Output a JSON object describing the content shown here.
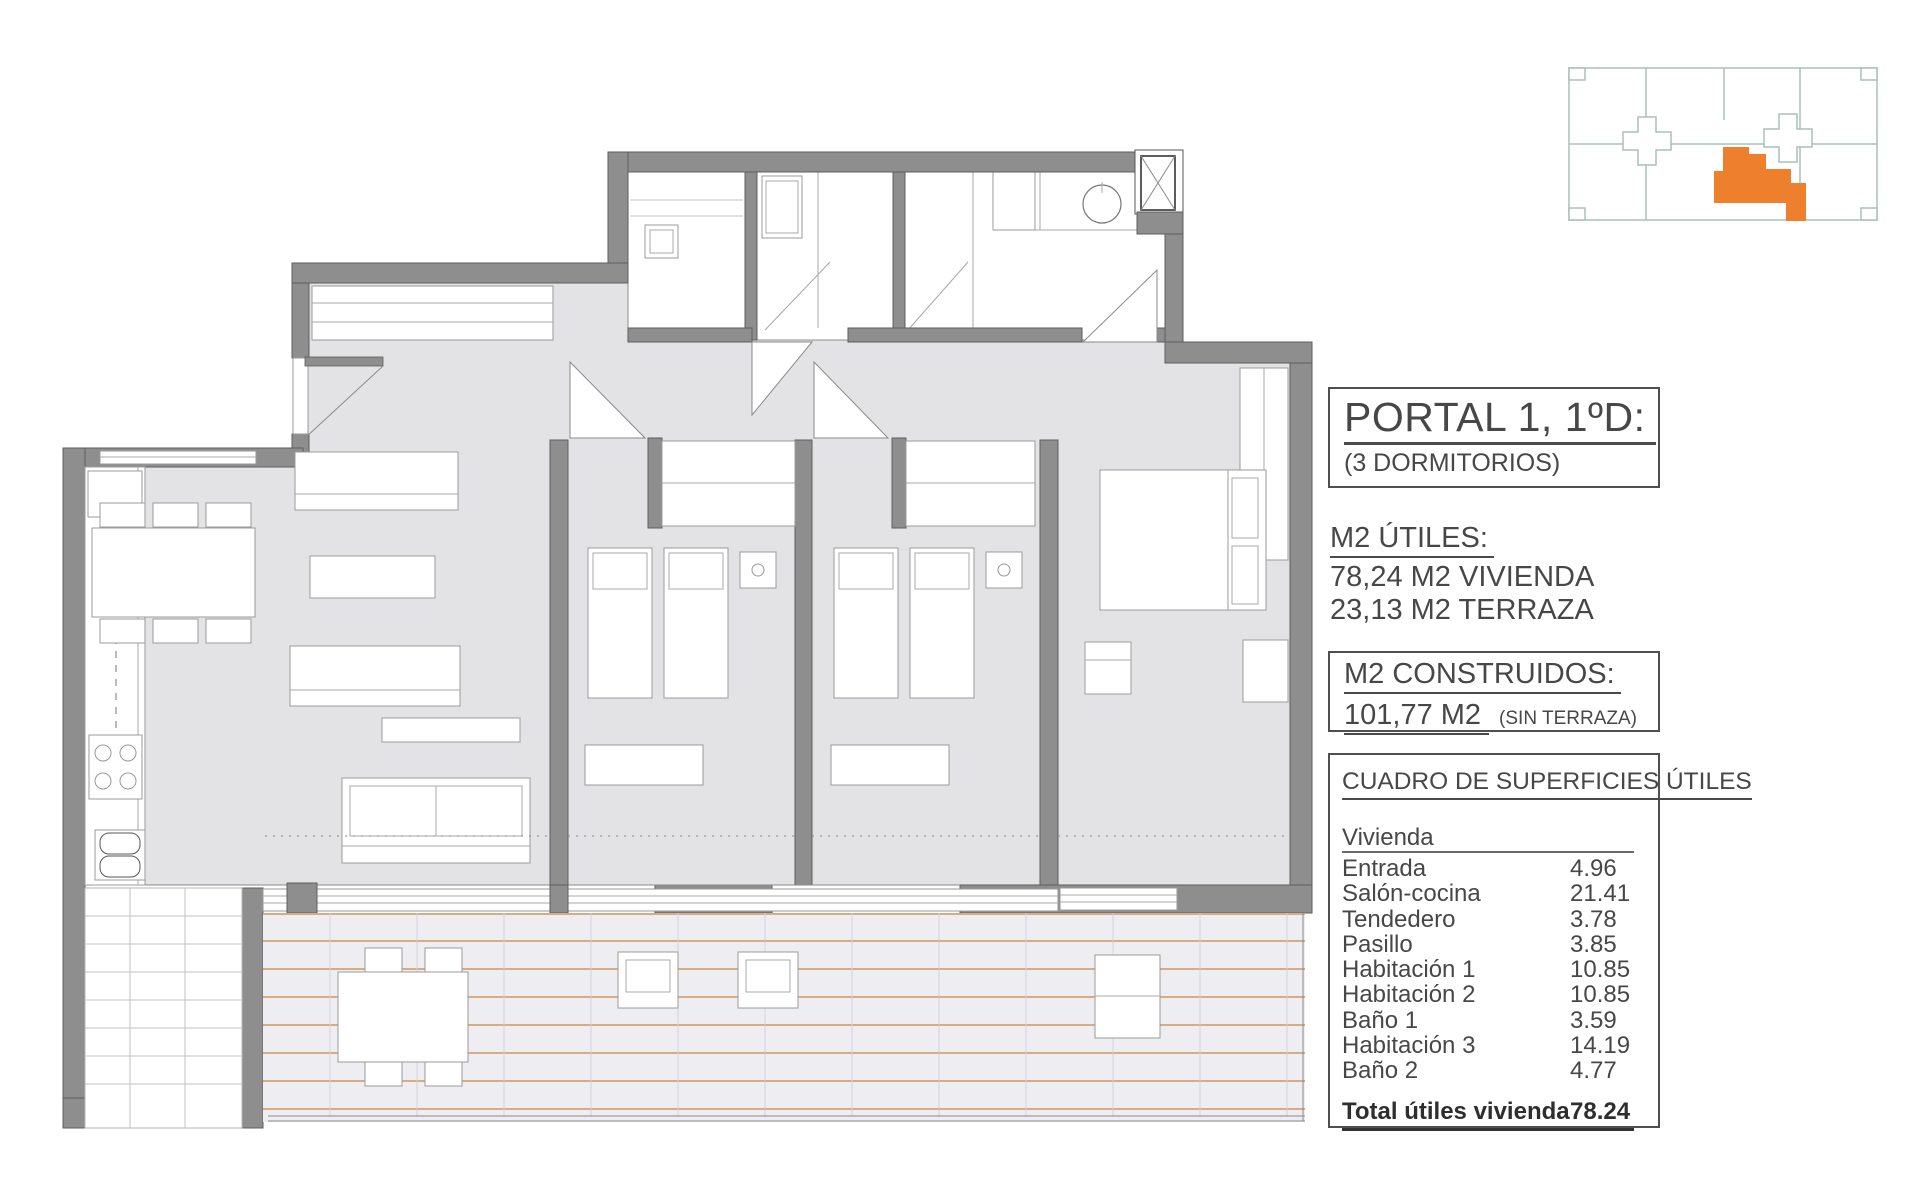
{
  "title_block": {
    "portal": {
      "title": "PORTAL 1, 1ºD:",
      "subtitle": "(3 DORMITORIOS)"
    },
    "utiles": {
      "heading": "M2 ÚTILES:",
      "line1": "78,24 M2 VIVIENDA",
      "line2": "23,13 M2 TERRAZA"
    },
    "construidos": {
      "heading": "M2 CONSTRUIDOS:",
      "value": "101,77 M2",
      "note": "(SIN TERRAZA)"
    },
    "surfaces": {
      "heading": "CUADRO DE SUPERFICIES ÚTILES",
      "group": "Vivienda",
      "rows": [
        {
          "label": "Entrada",
          "value": "4.96"
        },
        {
          "label": "Salón-cocina",
          "value": "21.41"
        },
        {
          "label": "Tendedero",
          "value": "3.78"
        },
        {
          "label": "Pasillo",
          "value": "3.85"
        },
        {
          "label": "Habitación 1",
          "value": "10.85"
        },
        {
          "label": "Habitación 2",
          "value": "10.85"
        },
        {
          "label": "Baño 1",
          "value": "3.59"
        },
        {
          "label": "Habitación 3",
          "value": "14.19"
        },
        {
          "label": "Baño 2",
          "value": "4.77"
        }
      ],
      "total": {
        "label": "Total útiles vivienda",
        "value": "78.24"
      }
    }
  },
  "key_plan": {
    "highlight_color": "#ee7f2d",
    "outline_color": "#a8c0b8"
  },
  "plan_colors": {
    "wall": "#8e8e8e",
    "floor": "#e3e3e5",
    "terrace_line": "#c8853c",
    "furniture_outline": "#9b9b9b"
  },
  "icons": [
    "elevator-icon",
    "washbasin-icon",
    "washer-icon",
    "kitchen-sink-icon",
    "cooktop-icon",
    "door-swing"
  ]
}
